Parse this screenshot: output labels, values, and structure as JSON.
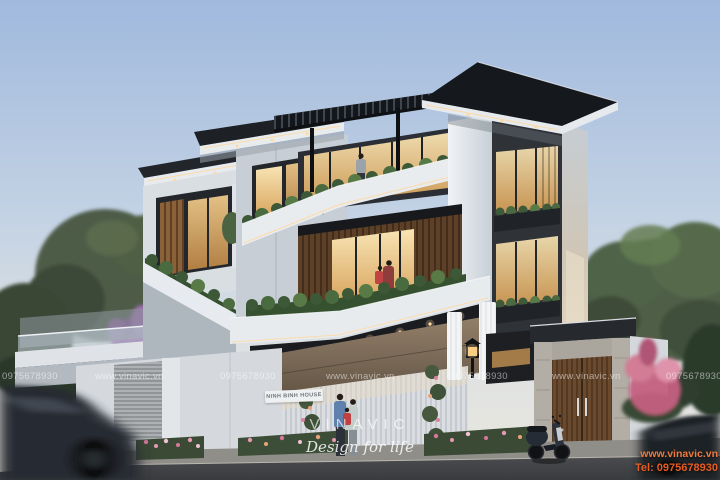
{
  "sign": {
    "text": "NINH BINH HOUSE"
  },
  "watermark": {
    "row": [
      {
        "text": "0975678930"
      },
      {
        "text": "www.vinavic.vn"
      },
      {
        "text": "0975678930"
      },
      {
        "text": "www.vinavic.vn"
      },
      {
        "text": "0975678930"
      },
      {
        "text": "www.vinavic.vn"
      },
      {
        "text": "0975678930"
      }
    ],
    "brand": "VINAVIC",
    "tagline": "Design for life",
    "corner_site": "www.vinavic.vn",
    "corner_tel": "Tel: 0975678930"
  },
  "colors": {
    "contact_accent": "#e85b22",
    "watermark_white": "rgba(255,255,255,0.52)",
    "sky_top": "#a7bedf",
    "window_glow": "#f2d49a",
    "hedge_green": "#3c5837"
  }
}
